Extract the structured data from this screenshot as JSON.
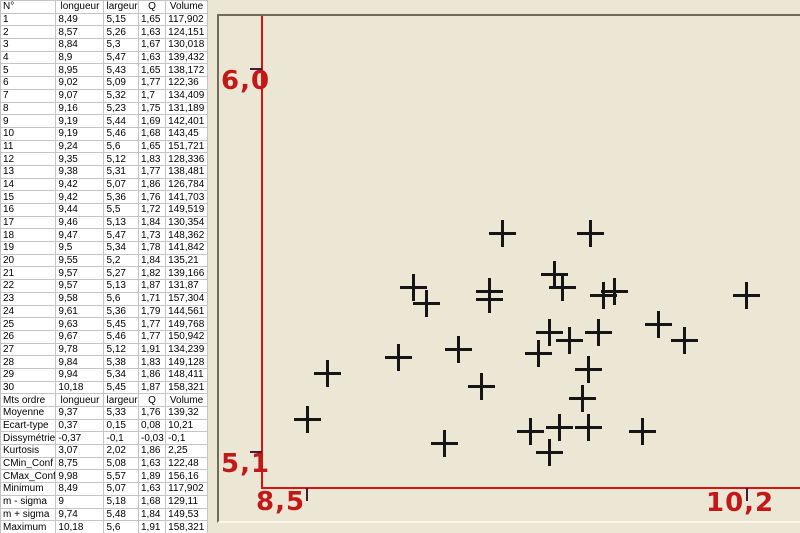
{
  "table": {
    "headers": [
      "N°",
      "longueur",
      "largeur",
      "Q",
      "Volume"
    ],
    "rows": [
      [
        "1",
        "8,49",
        "5,15",
        "1,65",
        "117,902"
      ],
      [
        "2",
        "8,57",
        "5,26",
        "1,63",
        "124,151"
      ],
      [
        "3",
        "8,84",
        "5,3",
        "1,67",
        "130,018"
      ],
      [
        "4",
        "8,9",
        "5,47",
        "1,63",
        "139,432"
      ],
      [
        "5",
        "8,95",
        "5,43",
        "1,65",
        "138,172"
      ],
      [
        "6",
        "9,02",
        "5,09",
        "1,77",
        "122,36"
      ],
      [
        "7",
        "9,07",
        "5,32",
        "1,7",
        "134,409"
      ],
      [
        "8",
        "9,16",
        "5,23",
        "1,75",
        "131,189"
      ],
      [
        "9",
        "9,19",
        "5,44",
        "1,69",
        "142,401"
      ],
      [
        "10",
        "9,19",
        "5,46",
        "1,68",
        "143,45"
      ],
      [
        "11",
        "9,24",
        "5,6",
        "1,65",
        "151,721"
      ],
      [
        "12",
        "9,35",
        "5,12",
        "1,83",
        "128,336"
      ],
      [
        "13",
        "9,38",
        "5,31",
        "1,77",
        "138,481"
      ],
      [
        "14",
        "9,42",
        "5,07",
        "1,86",
        "126,784"
      ],
      [
        "15",
        "9,42",
        "5,36",
        "1,76",
        "141,703"
      ],
      [
        "16",
        "9,44",
        "5,5",
        "1,72",
        "149,519"
      ],
      [
        "17",
        "9,46",
        "5,13",
        "1,84",
        "130,354"
      ],
      [
        "18",
        "9,47",
        "5,47",
        "1,73",
        "148,362"
      ],
      [
        "19",
        "9,5",
        "5,34",
        "1,78",
        "141,842"
      ],
      [
        "20",
        "9,55",
        "5,2",
        "1,84",
        "135,21"
      ],
      [
        "21",
        "9,57",
        "5,27",
        "1,82",
        "139,166"
      ],
      [
        "22",
        "9,57",
        "5,13",
        "1,87",
        "131,87"
      ],
      [
        "23",
        "9,58",
        "5,6",
        "1,71",
        "157,304"
      ],
      [
        "24",
        "9,61",
        "5,36",
        "1,79",
        "144,561"
      ],
      [
        "25",
        "9,63",
        "5,45",
        "1,77",
        "149,768"
      ],
      [
        "26",
        "9,67",
        "5,46",
        "1,77",
        "150,942"
      ],
      [
        "27",
        "9,78",
        "5,12",
        "1,91",
        "134,239"
      ],
      [
        "28",
        "9,84",
        "5,38",
        "1,83",
        "149,128"
      ],
      [
        "29",
        "9,94",
        "5,34",
        "1,86",
        "148,411"
      ],
      [
        "30",
        "10,18",
        "5,45",
        "1,87",
        "158,321"
      ]
    ],
    "stats_header": [
      "Mts ordre",
      "longueur",
      "largeur",
      "Q",
      "Volume"
    ],
    "stats_rows": [
      [
        "Moyenne",
        "9,37",
        "5,33",
        "1,76",
        "139,32"
      ],
      [
        "Ecart-type",
        "0,37",
        "0,15",
        "0,08",
        "10,21"
      ],
      [
        "Dissymétrie",
        "-0,37",
        "-0,1",
        "-0,03",
        "-0,1"
      ],
      [
        "Kurtosis",
        "3,07",
        "2,02",
        "1,86",
        "2,25"
      ],
      [
        "CMin_Conf",
        "8,75",
        "5,08",
        "1,63",
        "122,48"
      ],
      [
        "CMax_Conf",
        "9,98",
        "5,57",
        "1,89",
        "156,16"
      ],
      [
        "Minimum",
        "8,49",
        "5,07",
        "1,63",
        "117,902"
      ],
      [
        "m - sigma",
        "9",
        "5,18",
        "1,68",
        "129,11"
      ],
      [
        "m + sigma",
        "9,74",
        "5,48",
        "1,84",
        "149,53"
      ],
      [
        "Maximum",
        "10,18",
        "5,6",
        "1,91",
        "158,321"
      ]
    ]
  },
  "chart_data": {
    "type": "scatter",
    "x_field": "longueur",
    "y_field": "largeur",
    "marker": "plus",
    "grid": false,
    "legend": "none",
    "points": [
      [
        8.49,
        5.15
      ],
      [
        8.57,
        5.26
      ],
      [
        8.84,
        5.3
      ],
      [
        8.9,
        5.47
      ],
      [
        8.95,
        5.43
      ],
      [
        9.02,
        5.09
      ],
      [
        9.07,
        5.32
      ],
      [
        9.16,
        5.23
      ],
      [
        9.19,
        5.44
      ],
      [
        9.19,
        5.46
      ],
      [
        9.24,
        5.6
      ],
      [
        9.35,
        5.12
      ],
      [
        9.38,
        5.31
      ],
      [
        9.42,
        5.07
      ],
      [
        9.42,
        5.36
      ],
      [
        9.44,
        5.5
      ],
      [
        9.46,
        5.13
      ],
      [
        9.47,
        5.47
      ],
      [
        9.5,
        5.34
      ],
      [
        9.55,
        5.2
      ],
      [
        9.57,
        5.27
      ],
      [
        9.57,
        5.13
      ],
      [
        9.58,
        5.6
      ],
      [
        9.61,
        5.36
      ],
      [
        9.63,
        5.45
      ],
      [
        9.67,
        5.46
      ],
      [
        9.78,
        5.12
      ],
      [
        9.84,
        5.38
      ],
      [
        9.94,
        5.34
      ],
      [
        10.18,
        5.45
      ]
    ],
    "x_ticks": [
      {
        "label": "8,5",
        "value": 8.49
      },
      {
        "label": "10,2",
        "value": 10.18
      }
    ],
    "y_ticks": [
      {
        "label": "5,1",
        "value": 5.07
      },
      {
        "label": "6,0",
        "value": 6.0
      }
    ],
    "colors": {
      "axis": "#dc1212",
      "tick": "#441c38",
      "label": "#c31818",
      "marker": "#151515",
      "plot_bg": "#ece6d5"
    }
  }
}
